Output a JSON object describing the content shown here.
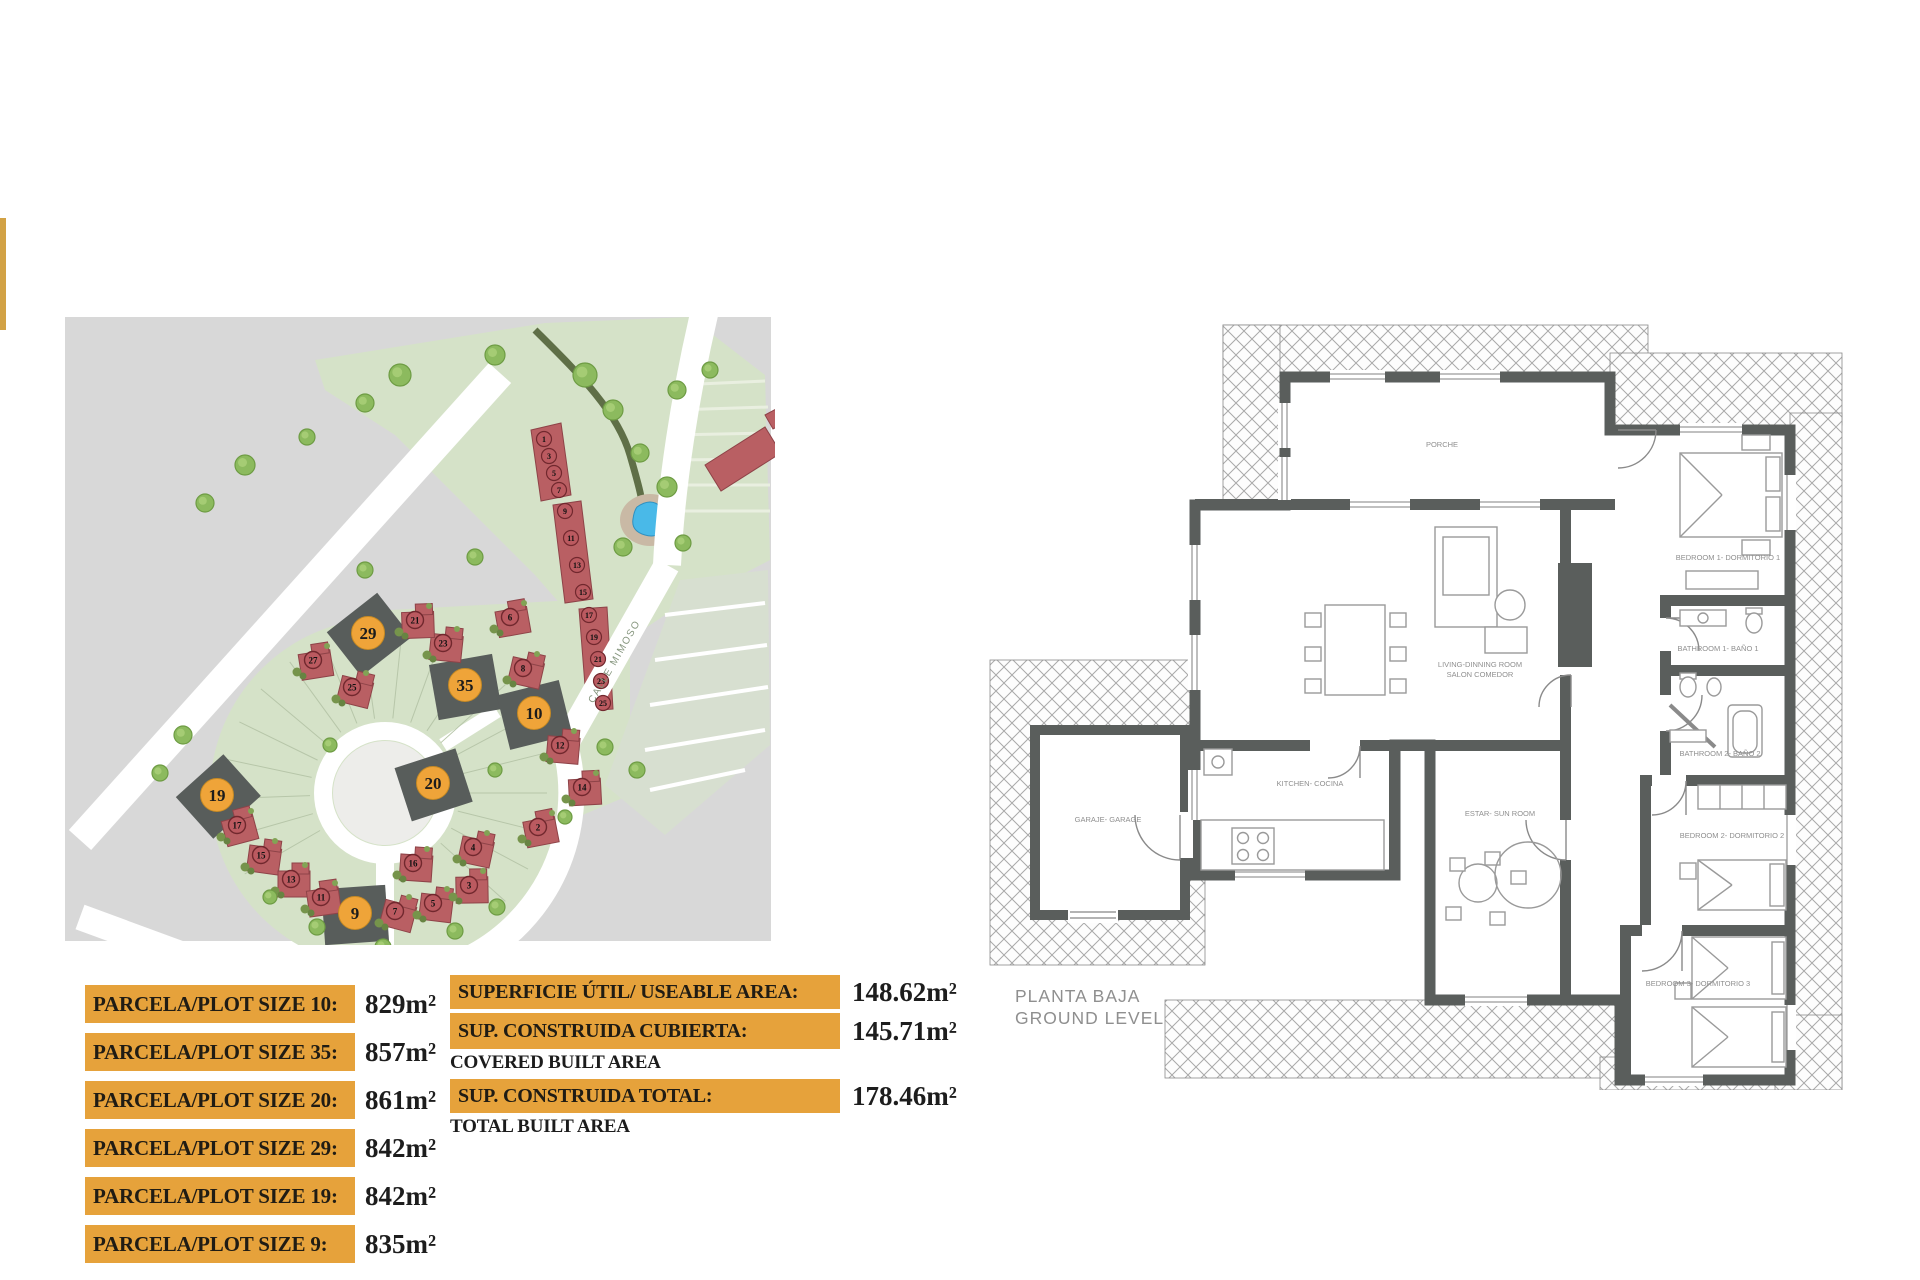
{
  "accent_bar_color": "#d2a245",
  "highlight_orange": "#e6a23b",
  "plot_table": {
    "rows": [
      {
        "label": "PARCELA/PLOT SIZE 10:",
        "value": "829m²"
      },
      {
        "label": "PARCELA/PLOT SIZE 35:",
        "value": "857m²"
      },
      {
        "label": "PARCELA/PLOT SIZE 20:",
        "value": "861m²"
      },
      {
        "label": "PARCELA/PLOT SIZE 29:",
        "value": "842m²"
      },
      {
        "label": "PARCELA/PLOT SIZE 19:",
        "value": "842m²"
      },
      {
        "label": "PARCELA/PLOT SIZE 9:",
        "value": "835m²"
      }
    ]
  },
  "area_table": {
    "rows": [
      {
        "label": "SUPERFICIE ÚTIL/ USEABLE AREA:",
        "caption": "",
        "value": "148.62m²"
      },
      {
        "label": "SUP. CONSTRUIDA CUBIERTA:",
        "caption": "COVERED BUILT AREA",
        "value": "145.71m²"
      },
      {
        "label": "SUP. CONSTRUIDA TOTAL:",
        "caption": "TOTAL BUILT AREA",
        "value": "178.46m²"
      }
    ]
  },
  "floorplan": {
    "title_line1": "PLANTA BAJA",
    "title_line2": "GROUND LEVEL",
    "rooms": {
      "porch": "PORCHE",
      "living1": "LIVING-DINNING ROOM",
      "living2": "SALON COMEDOR",
      "bedroom1": "BEDROOM 1- DORMITORIO 1",
      "bathroom1": "BATHROOM 1- BAÑO 1",
      "bathroom2": "BATHROOM 2- BAÑO 2",
      "bedroom2": "BEDROOM 2- DORMITORIO 2",
      "bedroom3": "BEDROOM 3- DORMITORIO 3",
      "kitchen": "KITCHEN- COCINA",
      "sunroom": "ESTAR- SUN ROOM",
      "garage": "GARAJE- GARAGE"
    }
  },
  "siteplan": {
    "street_label": "CALLE MIMOSO",
    "highlighted_plots": [
      {
        "n": "29",
        "x": 303,
        "y": 318,
        "rot": -38
      },
      {
        "n": "35",
        "x": 400,
        "y": 370,
        "rot": -10
      },
      {
        "n": "10",
        "x": 469,
        "y": 398,
        "rot": -14
      },
      {
        "n": "20",
        "x": 368,
        "y": 468,
        "rot": -18
      },
      {
        "n": "19",
        "x": 152,
        "y": 480,
        "rot": -42
      },
      {
        "n": "9",
        "x": 290,
        "y": 598,
        "rot": -4
      }
    ],
    "red_plots": [
      {
        "n": "17",
        "x": 172,
        "y": 510
      },
      {
        "n": "15",
        "x": 196,
        "y": 540
      },
      {
        "n": "13",
        "x": 226,
        "y": 564
      },
      {
        "n": "11",
        "x": 256,
        "y": 582
      },
      {
        "n": "7",
        "x": 330,
        "y": 596
      },
      {
        "n": "5",
        "x": 368,
        "y": 588
      },
      {
        "n": "3",
        "x": 404,
        "y": 570
      },
      {
        "n": "27",
        "x": 248,
        "y": 345
      },
      {
        "n": "25",
        "x": 287,
        "y": 372
      },
      {
        "n": "23",
        "x": 378,
        "y": 328
      },
      {
        "n": "21",
        "x": 350,
        "y": 305
      },
      {
        "n": "6",
        "x": 445,
        "y": 302
      },
      {
        "n": "8",
        "x": 458,
        "y": 353
      },
      {
        "n": "12",
        "x": 495,
        "y": 430
      },
      {
        "n": "14",
        "x": 517,
        "y": 472
      },
      {
        "n": "2",
        "x": 473,
        "y": 512
      },
      {
        "n": "4",
        "x": 408,
        "y": 532
      },
      {
        "n": "16",
        "x": 348,
        "y": 548
      }
    ],
    "strip_units": [
      {
        "n": "1",
        "x": 479,
        "y": 124
      },
      {
        "n": "3",
        "x": 484,
        "y": 141
      },
      {
        "n": "5",
        "x": 489,
        "y": 158
      },
      {
        "n": "7",
        "x": 494,
        "y": 175
      },
      {
        "n": "9",
        "x": 500,
        "y": 196
      },
      {
        "n": "11",
        "x": 506,
        "y": 223
      },
      {
        "n": "13",
        "x": 512,
        "y": 250
      },
      {
        "n": "15",
        "x": 518,
        "y": 277
      },
      {
        "n": "17",
        "x": 524,
        "y": 300
      },
      {
        "n": "19",
        "x": 529,
        "y": 322
      },
      {
        "n": "21",
        "x": 533,
        "y": 344
      },
      {
        "n": "23",
        "x": 536,
        "y": 366
      },
      {
        "n": "25",
        "x": 538,
        "y": 388
      }
    ],
    "trees": [
      [
        335,
        60,
        11
      ],
      [
        300,
        88,
        9
      ],
      [
        430,
        40,
        10
      ],
      [
        520,
        60,
        12
      ],
      [
        548,
        95,
        10
      ],
      [
        612,
        75,
        9
      ],
      [
        645,
        55,
        8
      ],
      [
        575,
        138,
        9
      ],
      [
        602,
        172,
        10
      ],
      [
        558,
        232,
        9
      ],
      [
        618,
        228,
        8
      ],
      [
        180,
        150,
        10
      ],
      [
        140,
        188,
        9
      ],
      [
        242,
        122,
        8
      ],
      [
        118,
        420,
        9
      ],
      [
        95,
        458,
        8
      ],
      [
        540,
        432,
        8
      ],
      [
        572,
        455,
        8
      ],
      [
        500,
        502,
        7
      ],
      [
        432,
        592,
        8
      ],
      [
        390,
        616,
        8
      ],
      [
        318,
        632,
        8
      ],
      [
        252,
        612,
        8
      ],
      [
        205,
        582,
        7
      ],
      [
        410,
        242,
        8
      ],
      [
        300,
        255,
        8
      ],
      [
        430,
        455,
        7
      ],
      [
        265,
        430,
        7
      ]
    ]
  }
}
